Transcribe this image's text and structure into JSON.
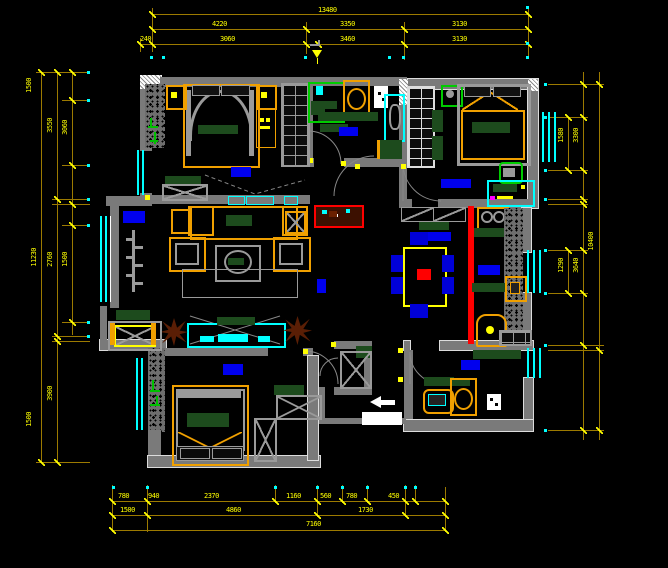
{
  "drawing": {
    "type": "residential-floor-plan-cad",
    "background": "#000000",
    "colors": {
      "wall": "#7a7a7a",
      "window": "#00ffff",
      "dim_line": "#9c7a00",
      "dim_text": "#ffff00",
      "room_label": "#0000ee",
      "furniture_accent": "#f0a000",
      "counter_top": "#1d4b1d",
      "divider_line": "#ff0000",
      "shower_enclosure": "#00cc00",
      "plant": "#5a1e05",
      "chair": "#0000d8",
      "entry_marker": "#ffffff"
    },
    "dims": {
      "top": {
        "overall": "13480",
        "row2": [
          "4220",
          "3350",
          "3130"
        ],
        "row3": [
          "240",
          "3060",
          "3460",
          "3130"
        ]
      },
      "bottom": {
        "row1": [
          "780",
          "940",
          "2370",
          "1160",
          "560",
          "780",
          "450"
        ],
        "row2": [
          "1500",
          "4860",
          "1730"
        ],
        "overall": "7160"
      },
      "left": {
        "overall": "11230",
        "mid": [
          "3550",
          "2760",
          "3900"
        ],
        "inner": [
          "3060",
          "1500"
        ],
        "edge": [
          "1500",
          "1500"
        ]
      },
      "right": {
        "overall": "10400",
        "mid": [
          "1580",
          "1290"
        ],
        "inner": [
          "3300",
          "3640"
        ]
      }
    },
    "rooms": [
      "master-bedroom",
      "bathroom",
      "bedroom-2",
      "hallway",
      "living-room",
      "dining-area",
      "kitchen",
      "bathroom-2",
      "bedroom-3",
      "balcony",
      "entry"
    ],
    "fixtures": [
      "double-bed",
      "nightstand",
      "wardrobe",
      "shower-enclosure",
      "toilet",
      "wash-basin",
      "ceiling-fan",
      "desk",
      "chair",
      "dining-table",
      "dining-chairs",
      "gas-stove",
      "kitchen-sink",
      "water-heater",
      "washing-machine",
      "sofa-set",
      "coffee-table",
      "tv-cabinet",
      "potted-plant",
      "balcony-bench",
      "entry-arrow"
    ]
  }
}
